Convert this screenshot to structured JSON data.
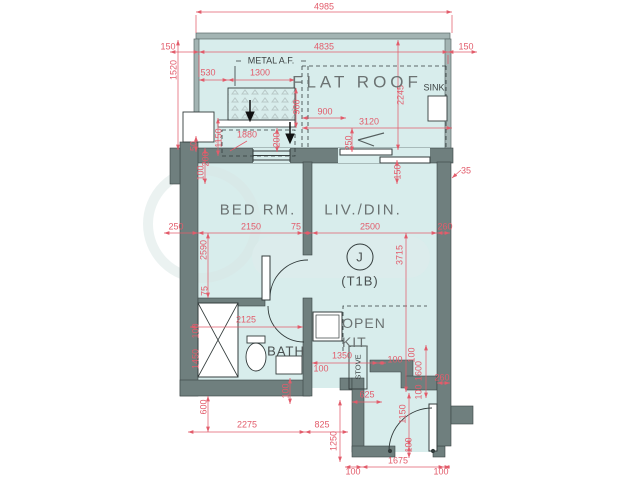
{
  "plan": {
    "unit_letter": "J",
    "unit_type": "(T1B)",
    "colors": {
      "dimension": "#e25c6b",
      "wall": "#6f7f7e",
      "floor": "#d8edec",
      "room_label": "#6b7272"
    }
  },
  "rooms": [
    {
      "t": "FLAT ROOF",
      "x": 357,
      "y": 82,
      "cls": "r17"
    },
    {
      "t": "METAL A.F.",
      "x": 271,
      "y": 61,
      "cls": "r9"
    },
    {
      "t": "SINK",
      "x": 434,
      "y": 88,
      "cls": "r9"
    },
    {
      "t": "BED RM.",
      "x": 258,
      "y": 210,
      "cls": "r16"
    },
    {
      "t": "LIV./DIN.",
      "x": 363,
      "y": 210,
      "cls": "r16"
    },
    {
      "t": "J",
      "x": 360,
      "y": 257,
      "cls": "r13"
    },
    {
      "t": "(T1B)",
      "x": 360,
      "y": 281,
      "cls": "r13"
    },
    {
      "t": "BATH",
      "x": 286,
      "y": 351,
      "cls": "r13"
    },
    {
      "t": "OPEN",
      "x": 364,
      "y": 323,
      "cls": "r15"
    },
    {
      "t": "KIT.",
      "x": 356,
      "y": 342,
      "cls": "r15"
    },
    {
      "t": "STOVE",
      "x": 358,
      "y": 367,
      "rot": true,
      "cls": "r8"
    }
  ],
  "dimensions": [
    {
      "t": "4985",
      "x": 324,
      "y": 7
    },
    {
      "t": "150",
      "x": 168,
      "y": 47
    },
    {
      "t": "4835",
      "x": 324,
      "y": 47
    },
    {
      "t": "150",
      "x": 466,
      "y": 47
    },
    {
      "t": "1520",
      "x": 174,
      "y": 70,
      "rot": true
    },
    {
      "t": "530",
      "x": 208,
      "y": 73
    },
    {
      "t": "1300",
      "x": 260,
      "y": 73
    },
    {
      "t": "2245",
      "x": 401,
      "y": 95,
      "rot": true
    },
    {
      "t": "900",
      "x": 297,
      "y": 107,
      "rot": true
    },
    {
      "t": "900",
      "x": 325,
      "y": 112
    },
    {
      "t": "3120",
      "x": 369,
      "y": 122
    },
    {
      "t": "1880",
      "x": 247,
      "y": 135
    },
    {
      "t": "200",
      "x": 277,
      "y": 140,
      "rot": true
    },
    {
      "t": "1150",
      "x": 219,
      "y": 138,
      "rot": true
    },
    {
      "t": "50",
      "x": 194,
      "y": 146,
      "rot": true
    },
    {
      "t": "200",
      "x": 206,
      "y": 159,
      "rot": true
    },
    {
      "t": "100",
      "x": 201,
      "y": 173,
      "rot": true
    },
    {
      "t": "250",
      "x": 349,
      "y": 143,
      "rot": true
    },
    {
      "t": "150",
      "x": 398,
      "y": 172,
      "rot": true
    },
    {
      "t": "35",
      "x": 466,
      "y": 171
    },
    {
      "t": "250",
      "x": 176,
      "y": 227
    },
    {
      "t": "2150",
      "x": 251,
      "y": 227
    },
    {
      "t": "75",
      "x": 296,
      "y": 227
    },
    {
      "t": "2500",
      "x": 370,
      "y": 227
    },
    {
      "t": "260",
      "x": 445,
      "y": 227
    },
    {
      "t": "2590",
      "x": 204,
      "y": 250,
      "rot": true
    },
    {
      "t": "3715",
      "x": 400,
      "y": 255,
      "rot": true
    },
    {
      "t": "75",
      "x": 205,
      "y": 291,
      "rot": true
    },
    {
      "t": "2125",
      "x": 246,
      "y": 320
    },
    {
      "t": "100",
      "x": 196,
      "y": 331,
      "rot": true
    },
    {
      "t": "1450",
      "x": 196,
      "y": 359,
      "rot": true
    },
    {
      "t": "1350",
      "x": 342,
      "y": 356
    },
    {
      "t": "100",
      "x": 395,
      "y": 360
    },
    {
      "t": "100",
      "x": 321,
      "y": 369
    },
    {
      "t": "100",
      "x": 286,
      "y": 391,
      "rot": true
    },
    {
      "t": "100",
      "x": 412,
      "y": 355,
      "rot": true
    },
    {
      "t": "1600",
      "x": 419,
      "y": 371,
      "rot": true
    },
    {
      "t": "100",
      "x": 419,
      "y": 392,
      "rot": true
    },
    {
      "t": "260",
      "x": 442,
      "y": 378
    },
    {
      "t": "600",
      "x": 204,
      "y": 407,
      "rot": true
    },
    {
      "t": "1250",
      "x": 334,
      "y": 441,
      "rot": true
    },
    {
      "t": "2275",
      "x": 247,
      "y": 425
    },
    {
      "t": "825",
      "x": 322,
      "y": 425
    },
    {
      "t": "625",
      "x": 367,
      "y": 395
    },
    {
      "t": "1150",
      "x": 403,
      "y": 414,
      "rot": true
    },
    {
      "t": "100",
      "x": 409,
      "y": 445,
      "rot": true
    },
    {
      "t": "1675",
      "x": 398,
      "y": 461
    },
    {
      "t": "100",
      "x": 353,
      "y": 472
    },
    {
      "t": "100",
      "x": 441,
      "y": 472
    }
  ]
}
